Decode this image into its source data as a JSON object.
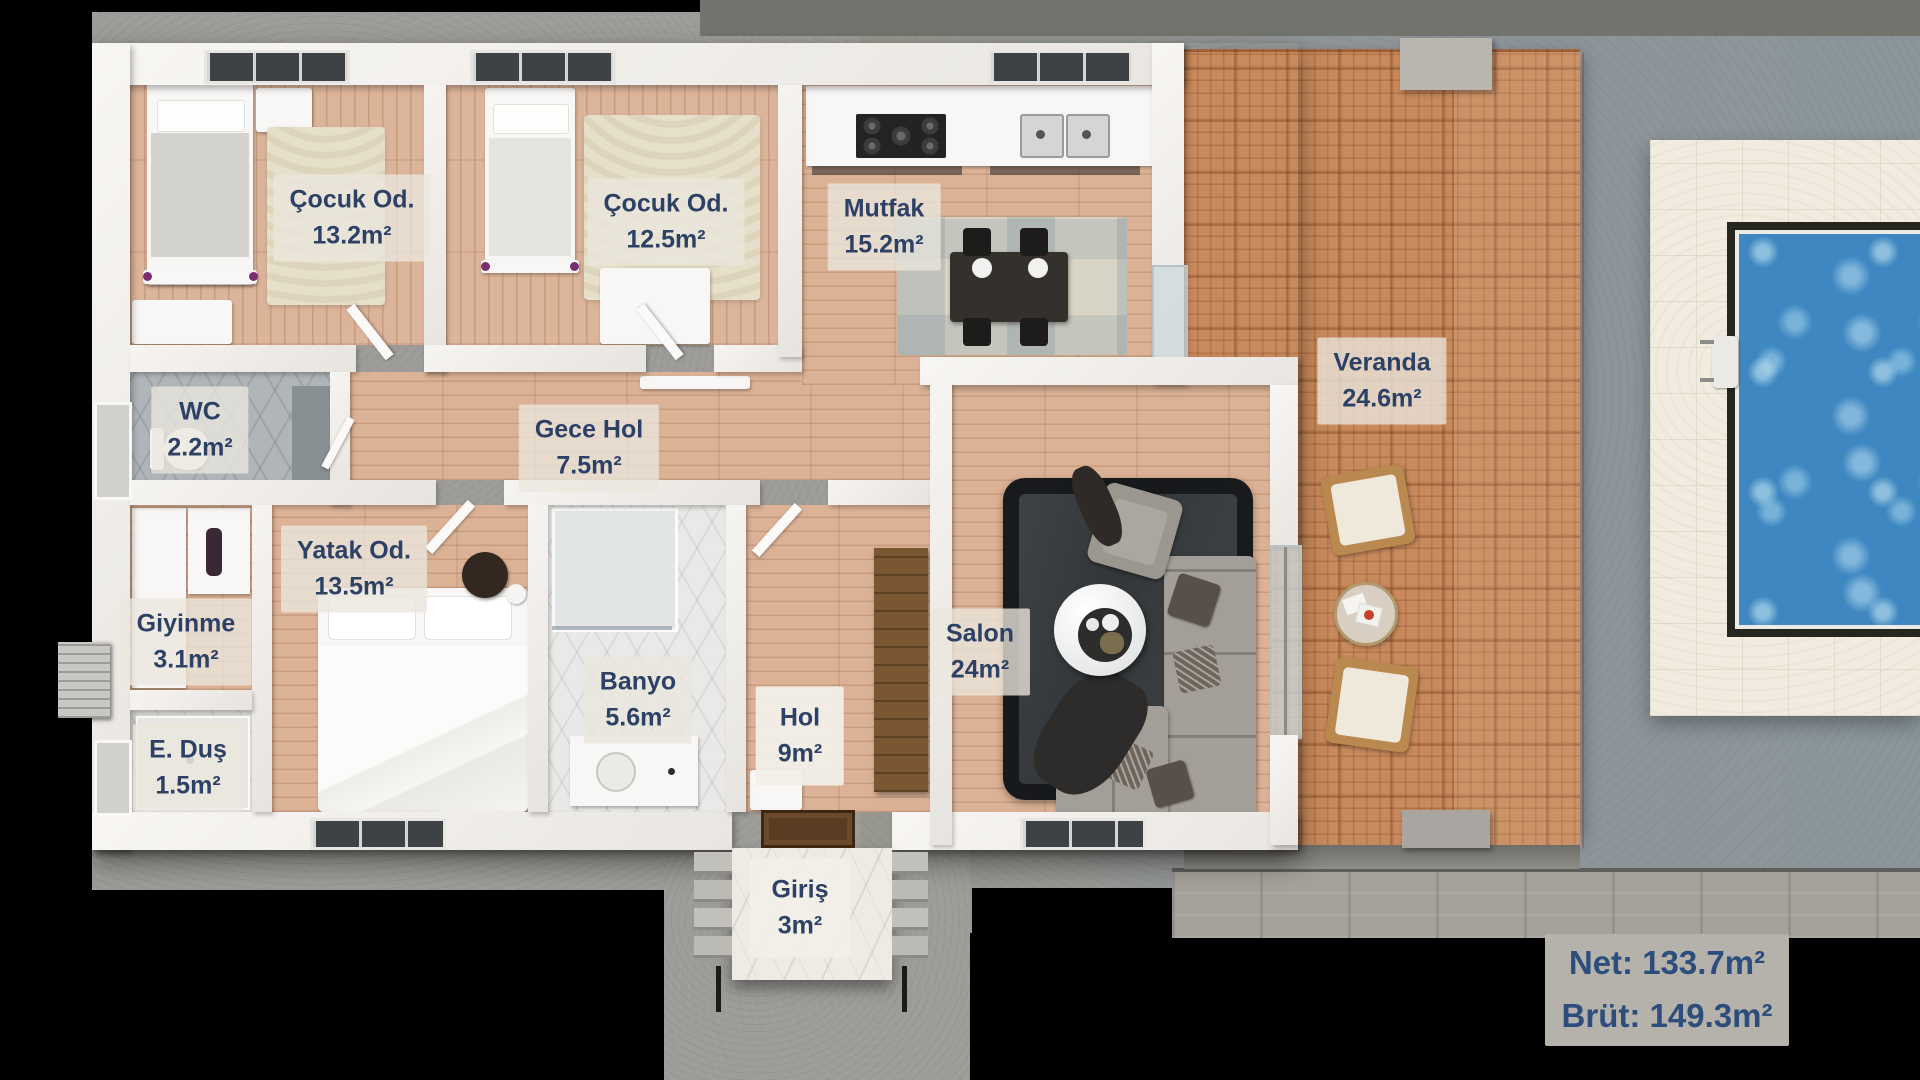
{
  "rooms": [
    {
      "id": "cocuk-odasi-1",
      "name": "Çocuk Od.",
      "area": "13.2m²"
    },
    {
      "id": "cocuk-odasi-2",
      "name": "Çocuk Od.",
      "area": "12.5m²"
    },
    {
      "id": "mutfak",
      "name": "Mutfak",
      "area": "15.2m²"
    },
    {
      "id": "veranda",
      "name": "Veranda",
      "area": "24.6m²"
    },
    {
      "id": "wc",
      "name": "WC",
      "area": "2.2m²"
    },
    {
      "id": "gece-hol",
      "name": "Gece Hol",
      "area": "7.5m²"
    },
    {
      "id": "yatak-odasi",
      "name": "Yatak Od.",
      "area": "13.5m²"
    },
    {
      "id": "giyinme",
      "name": "Giyinme",
      "area": "3.1m²"
    },
    {
      "id": "ebeveyn-dus",
      "name": "E. Duş",
      "area": "1.5m²"
    },
    {
      "id": "banyo",
      "name": "Banyo",
      "area": "5.6m²"
    },
    {
      "id": "hol",
      "name": "Hol",
      "area": "9m²"
    },
    {
      "id": "salon",
      "name": "Salon",
      "area": "24m²"
    },
    {
      "id": "giris",
      "name": "Giriş",
      "area": "3m²"
    }
  ],
  "summary": {
    "net": "Net: 133.7m²",
    "brut": "Brüt: 149.3m²"
  },
  "colors": {
    "label_text": "#2c4165",
    "label_chip_bg": "#ebe7de",
    "summary_bg": "#b5b2ab",
    "summary_text": "#2d4e7c",
    "wood_floor": "#dcb296",
    "veranda_deck": "#c8895c",
    "pool_water": "#3e87c1",
    "pool_deck": "#f1ecdf",
    "concrete": "#9d9c99",
    "wall": "#f4f2ee",
    "background": "#000000"
  }
}
